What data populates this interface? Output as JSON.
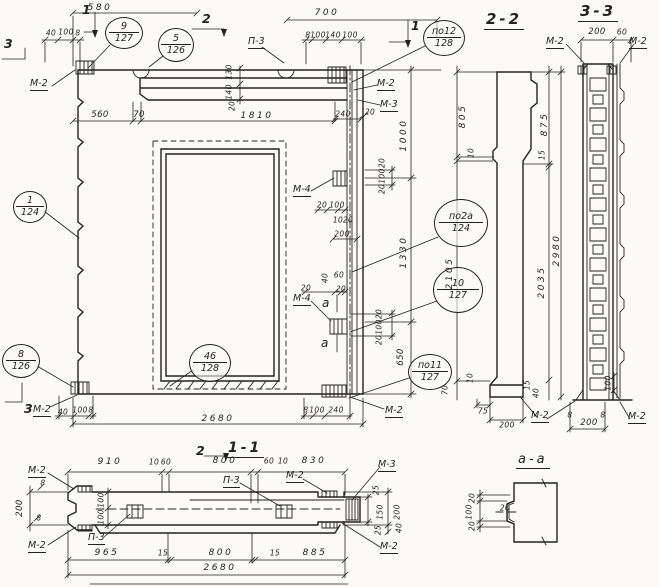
{
  "sheet": {
    "type_note": "precast wall panel shop drawing",
    "ink": "#24221e",
    "paper": "#fbfaf6"
  },
  "el": {
    "marks": {
      "m1a": "1",
      "m1b": "1",
      "m2": "2",
      "m3a": "3",
      "m3b": "3",
      "ma1": "a",
      "ma2": "a"
    },
    "labels": {
      "m2tl": "М-2",
      "p3": "П-3",
      "m2tr": "М-2",
      "m3tr": "М-3",
      "m4a": "М-4",
      "m4b": "М-4",
      "m2bl": "М-2",
      "m2br": "М-2"
    },
    "callouts": {
      "c9": {
        "num": "9",
        "sheet": "127"
      },
      "c5": {
        "num": "5",
        "sheet": "126"
      },
      "c12": {
        "num": "по12",
        "sheet": "128"
      },
      "c1": {
        "num": "1",
        "sheet": "124"
      },
      "c2a": {
        "num": "по2а",
        "sheet": "124"
      },
      "c10": {
        "num": "10",
        "sheet": "127"
      },
      "c8": {
        "num": "8",
        "sheet": "126"
      },
      "c46": {
        "num": "46",
        "sheet": "128"
      },
      "c11": {
        "num": "по11",
        "sheet": "127"
      }
    },
    "dims": {
      "d580": "580",
      "d700": "700",
      "d40tl": "40",
      "d100tl": "100",
      "d8tl": "8",
      "d8tr": "8",
      "d100tr1": "100",
      "d140tr": "140",
      "d100tr2": "100",
      "d560": "560",
      "d70": "70",
      "d1810": "1810",
      "d130": "130",
      "d140": "140",
      "d20l": "20",
      "d240t": "240",
      "d20t": "20",
      "d1000": "1000",
      "d1330": "1330",
      "d650": "650",
      "s1a": "20",
      "s1b": "100",
      "s1c": "20",
      "s2a": "20",
      "s2b": "100",
      "s2c": "20",
      "d20m4": "20",
      "d100m4": "100",
      "d10m4": "10",
      "d20m4b": "20",
      "d200m4": "200",
      "d40mid": "40",
      "d60mid": "60",
      "d20mid1": "20",
      "d20mid2": "20",
      "d40bl": "40",
      "d100bl": "100",
      "d8bl": "8",
      "d8br": "8",
      "d100br": "100",
      "d240br": "240",
      "d2680": "2680"
    }
  },
  "s22": {
    "title": "2-2",
    "labels": {
      "m2": "М-2"
    },
    "dims": {
      "l805": "805",
      "l10": "10",
      "l2105": "2105",
      "r875": "875",
      "r15": "15",
      "r2035": "2035",
      "r2980": "2980",
      "b70": "70",
      "b10": "10",
      "b15": "15",
      "b40": "40",
      "b75": "75",
      "b200": "200"
    }
  },
  "s33": {
    "title": "3-3",
    "labels": {
      "m2tl": "М-2",
      "m2tr": "М-2",
      "m2br": "М-2"
    },
    "dims": {
      "t200": "200",
      "t60": "60",
      "b8a": "8",
      "b8b": "8",
      "b200": "200",
      "r100": "100"
    }
  },
  "s11": {
    "title": "1-1",
    "mark2": "2",
    "labels": {
      "m2tl": "М-2",
      "m2bl": "М-2",
      "p3a": "П-3",
      "p3b": "П-3",
      "m2mid": "М-2",
      "m3": "М-3",
      "m2br": "М-2"
    },
    "dims": {
      "t910": "910",
      "t10a": "10",
      "t60a": "60",
      "t800": "800",
      "t60b": "60",
      "t10b": "10",
      "t830": "830",
      "b965": "965",
      "b15a": "15",
      "b800": "800",
      "b15b": "15",
      "b885": "885",
      "b2680": "2680",
      "l200": "200",
      "l8a": "8",
      "l8b": "8",
      "l100a": "100",
      "l100b": "100",
      "r25a": "25",
      "r150": "150",
      "r25b": "25",
      "r200": "200",
      "r40": "40"
    }
  },
  "aa": {
    "title": "а-а",
    "dims": {
      "l20a": "20",
      "l100": "100",
      "l20b": "20",
      "n20": "20"
    }
  }
}
